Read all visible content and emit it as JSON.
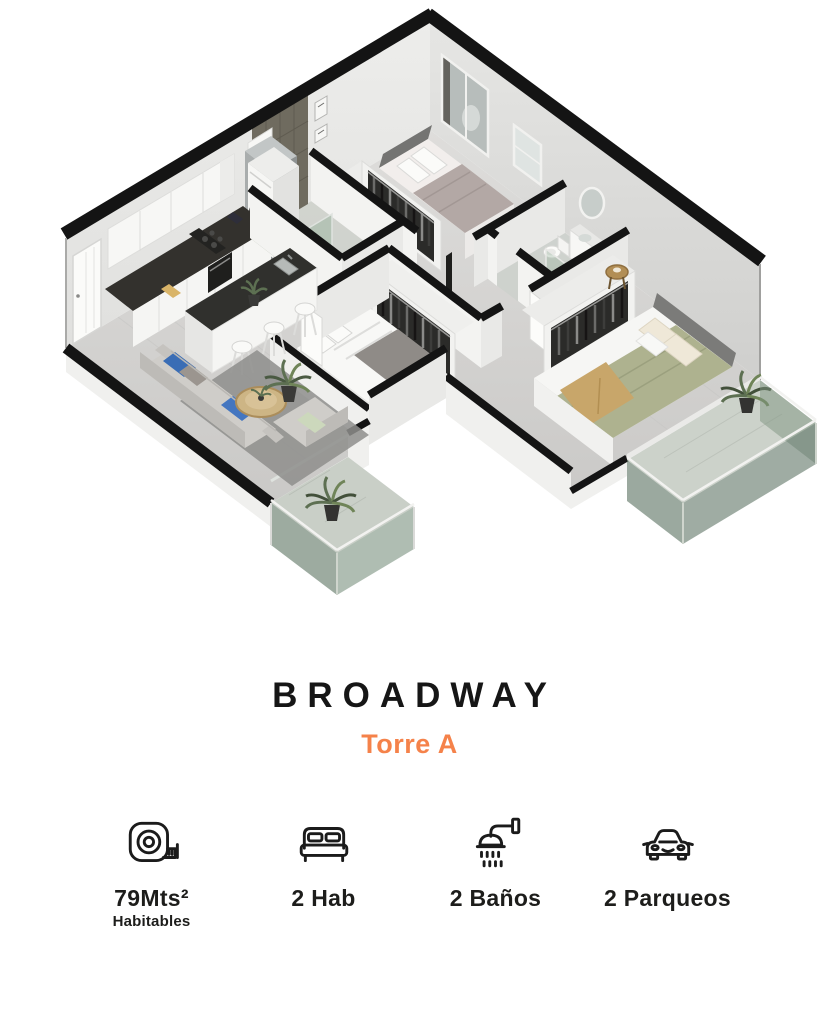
{
  "header": {
    "title": "BROADWAY",
    "subtitle": "Torre A"
  },
  "features": [
    {
      "icon": "measuring-tape-icon",
      "value": "79Mts²",
      "sublabel": "Habitables"
    },
    {
      "icon": "bed-icon",
      "value": "2 Hab",
      "sublabel": ""
    },
    {
      "icon": "shower-icon",
      "value": "2 Baños",
      "sublabel": ""
    },
    {
      "icon": "car-icon",
      "value": "2 Parqueos",
      "sublabel": ""
    }
  ],
  "colors": {
    "accent_orange": "#F5824A",
    "title_black": "#161616",
    "wall_cap_black": "#141414",
    "wall_face_light": "#ebebe9",
    "wall_face_shaded": "#d7d7d5",
    "floor_gray": "#d6d6d4",
    "tile_accent": "#6f6b5f",
    "balcony_glass_green": "#6e8672",
    "bedding_olive": "#aeb28f",
    "bedding_mauve": "#b3a8a5",
    "sofa_gray": "#cfcdc9",
    "pillow_blue": "#3a6db5",
    "pillow_green": "#ccd8bc",
    "wood": "#cdb585",
    "counter_dark": "#30302d",
    "plant_green": "#5d7052"
  }
}
